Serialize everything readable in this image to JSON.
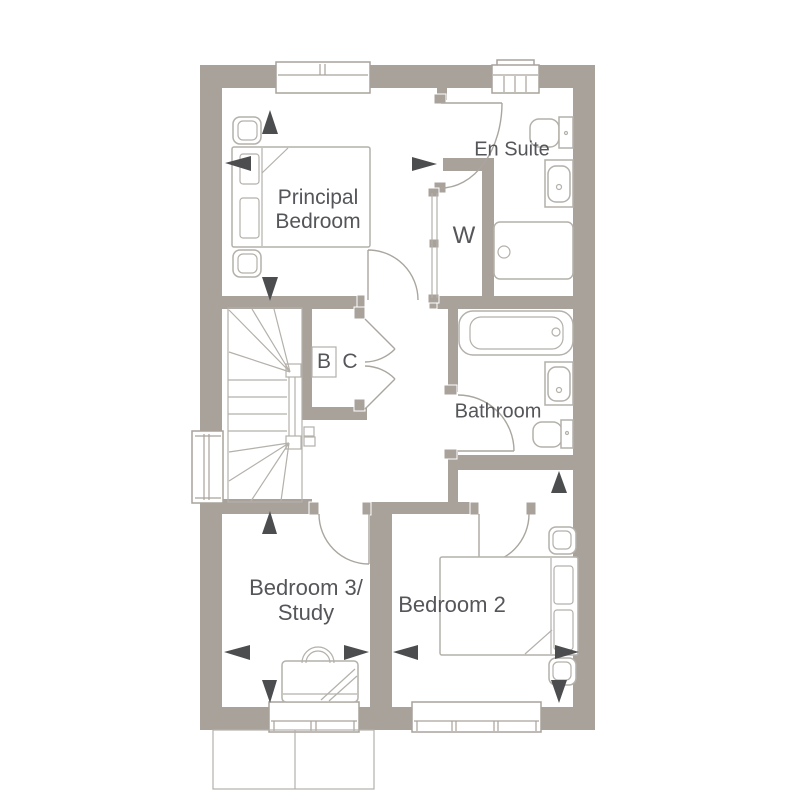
{
  "floor_plan": {
    "theme": {
      "wall_color": "#a9a29b",
      "line_color": "#b4b0aa",
      "door_color": "#aaa69f",
      "text_color": "#55565a",
      "arrow_color": "#4c4d4f",
      "floor_color": "#ffffff"
    },
    "labels": {
      "principal_bedroom_line1": "Principal",
      "principal_bedroom_line2": "Bedroom",
      "en_suite": "En Suite",
      "wardrobe": "W",
      "boiler": "B",
      "cupboard": "C",
      "bathroom": "Bathroom",
      "bedroom_2": "Bedroom 2",
      "bedroom_3_line1": "Bedroom 3/",
      "bedroom_3_line2": "Study"
    },
    "fixtures": [
      "double-bed",
      "bedside-table",
      "toilet",
      "basin",
      "shower",
      "bath",
      "sliding-wardrobe",
      "desk",
      "chair",
      "winder-stairs",
      "window",
      "door-swing",
      "dimension-arrow"
    ]
  }
}
